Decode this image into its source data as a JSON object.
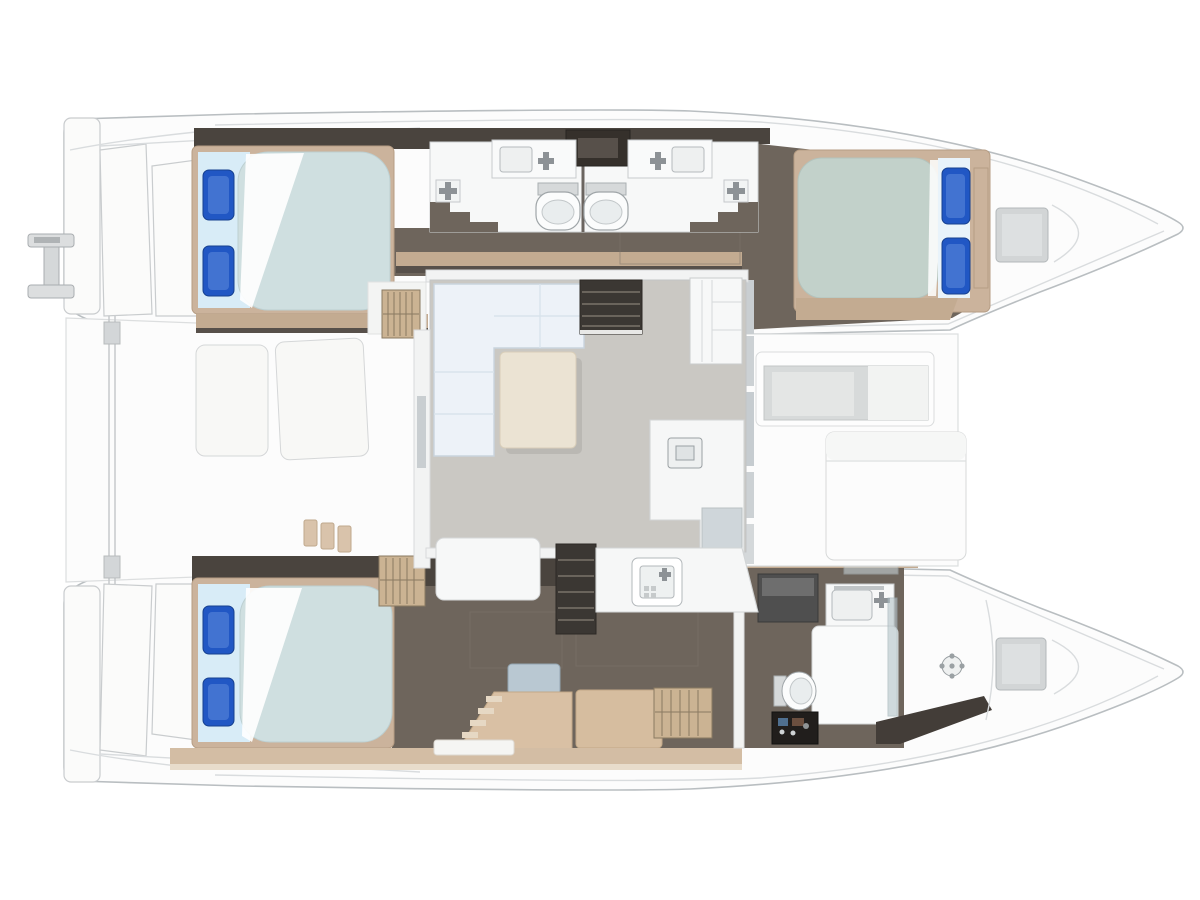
{
  "diagram": {
    "type": "yacht-floor-plan",
    "vessel": "catamaran",
    "view": "top-down deck plan",
    "orientation": {
      "bow": "right",
      "stern": "left"
    },
    "rooms": [
      {
        "id": "aft-cockpit",
        "label": "Aft cockpit",
        "furniture": [
          "cockpit table",
          "two bench seats",
          "boarding steps",
          "transom swim steps",
          "aft crossbeam"
        ]
      },
      {
        "id": "port-aft-cabin",
        "label": "Port aft double cabin",
        "furniture": [
          "double bed",
          "2 blue pillows",
          "wardrobe"
        ]
      },
      {
        "id": "port-heads",
        "label": "Two mirrored bathrooms",
        "furniture": [
          "2 vanity sinks",
          "2 toilets",
          "2 shower mixers",
          "dark cabinet"
        ]
      },
      {
        "id": "port-forward-cabin",
        "label": "Port forward double cabin",
        "furniture": [
          "double bed",
          "2 blue pillows"
        ]
      },
      {
        "id": "salon",
        "label": "Salon / bridgedeck",
        "furniture": [
          "L-shaped sofa",
          "coffee table",
          "fridge cabinet",
          "L-shaped counter",
          "companionway steps x2",
          "bench"
        ]
      },
      {
        "id": "galley",
        "label": "Galley",
        "furniture": [
          "counter",
          "sink unit"
        ]
      },
      {
        "id": "stbd-aft-cabin",
        "label": "Starboard aft double cabin",
        "furniture": [
          "double bed",
          "2 blue pillows",
          "wardrobe"
        ]
      },
      {
        "id": "stbd-corridor",
        "label": "Starboard hull corridor",
        "furniture": [
          "chaise bench",
          "blue stool",
          "louvered locker"
        ]
      },
      {
        "id": "stbd-bathroom",
        "label": "Starboard bathroom",
        "furniture": [
          "toilet",
          "vanity sink",
          "dark appliance",
          "shower tray",
          "glass partition",
          "shower drain",
          "black vanity box"
        ]
      },
      {
        "id": "bow-lockers",
        "label": "Bow lockers",
        "furniture": [
          "deck hatch port",
          "deck hatch starboard"
        ]
      },
      {
        "id": "forward-cockpit",
        "label": "Forward cockpit",
        "furniture": [
          "recessed seating well",
          "sun pad"
        ]
      }
    ],
    "counts": {
      "double_beds": 3,
      "toilets": 3,
      "sinks": 4,
      "showers": 1,
      "hulls": 2
    }
  },
  "palette": {
    "hull_fill": "#fcfcfc",
    "hull_stroke": "#b9bec1",
    "floor_dark": "#6e655c",
    "floor_shadow": "#4a443e",
    "wall_dark": "#35302b",
    "wood_light": "#cbb39c",
    "walkway_tan": "#c3ab91",
    "louver_tan": "#cbb393",
    "bench_tan": "#d9c0a4",
    "bed_sheet": "#d8ecf7",
    "mattress_pale": "#cfdfe0",
    "mattress_green": "#c2d1ca",
    "pillow_blue": "#2157c4",
    "pillow_blue_light": "#5e8bdc",
    "salon_floor": "#cac8c3",
    "sofa_white": "#edf2f8",
    "table_cream": "#ebe3d3",
    "counter_white": "#f6f7f7",
    "steps_dark": "#3b3733",
    "appliance_gray": "#4f4f4f",
    "glass_gray": "#b9c7cc",
    "fixture_metal": "#8d9296",
    "stool_blue": "#b9c8d2",
    "recess_gray": "#d7dada",
    "hatch_gray": "#d2d5d6"
  }
}
